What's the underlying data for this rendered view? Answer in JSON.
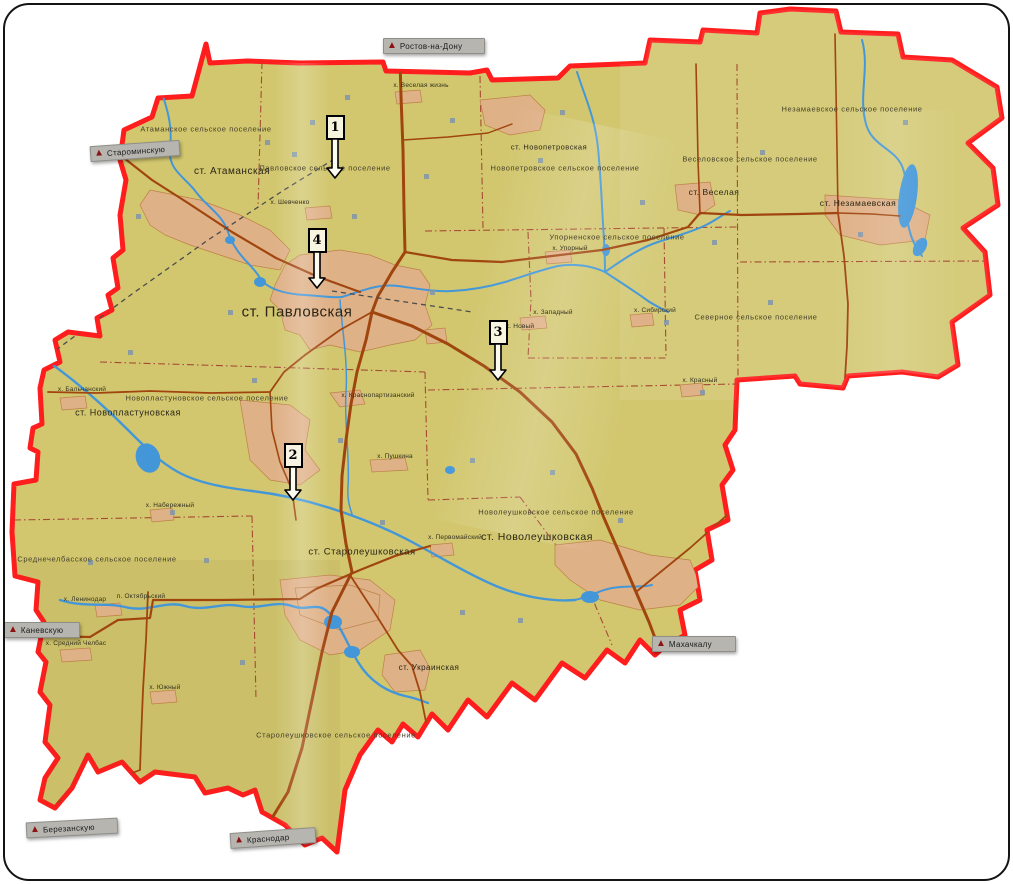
{
  "map_name": "district-wall-map-photo",
  "colors": {
    "land": "#d2c76f",
    "district_border": "#ff1d1d",
    "river": "#4397d9",
    "road": "#a1450f",
    "urban": "#dfb187",
    "urban_edge": "#bd8147",
    "settlement_boundary": "#a64a33",
    "railway": "#4c4c4c",
    "sign_background": "#b6b5b0",
    "sign_text": "#1b1b1b"
  },
  "stations": [
    {
      "label": "ст. Павловская",
      "x": 297,
      "y": 312,
      "size": 15
    },
    {
      "label": "ст. Атаманская",
      "x": 232,
      "y": 172,
      "size": 10
    },
    {
      "label": "ст. Новопетровская",
      "x": 549,
      "y": 147,
      "size": 7.5
    },
    {
      "label": "ст. Веселая",
      "x": 714,
      "y": 192,
      "size": 8.5
    },
    {
      "label": "ст. Незамаевская",
      "x": 858,
      "y": 203,
      "size": 8.5
    },
    {
      "label": "ст. Новопластуновская",
      "x": 128,
      "y": 413,
      "size": 9
    },
    {
      "label": "ст. Старолеушковская",
      "x": 362,
      "y": 552,
      "size": 9.5
    },
    {
      "label": "ст. Новолеушковская",
      "x": 537,
      "y": 537,
      "size": 10.5
    },
    {
      "label": "ст. Украинская",
      "x": 429,
      "y": 668,
      "size": 8
    }
  ],
  "settlements": [
    {
      "label": "Атаманское сельское поселение",
      "x": 206,
      "y": 129
    },
    {
      "label": "Павловское сельское поселение",
      "x": 325,
      "y": 168
    },
    {
      "label": "Новопетровское сельское поселение",
      "x": 565,
      "y": 168
    },
    {
      "label": "Веселовское сельское поселение",
      "x": 750,
      "y": 159
    },
    {
      "label": "Незамаевское сельское поселение",
      "x": 852,
      "y": 109
    },
    {
      "label": "Упорненское сельское поселение",
      "x": 617,
      "y": 237
    },
    {
      "label": "Северное сельское поселение",
      "x": 756,
      "y": 317
    },
    {
      "label": "Новопластуновское сельское поселение",
      "x": 207,
      "y": 398
    },
    {
      "label": "Среднечелбасское сельское поселение",
      "x": 97,
      "y": 559
    },
    {
      "label": "Новолеушковское сельское поселение",
      "x": 556,
      "y": 512
    },
    {
      "label": "Старолеушковское сельское поселение",
      "x": 336,
      "y": 735
    }
  ],
  "hamlets": [
    {
      "label": "х. Веселая жизнь",
      "x": 421,
      "y": 86
    },
    {
      "label": "х. Шевченко",
      "x": 290,
      "y": 203
    },
    {
      "label": "х. Упорный",
      "x": 570,
      "y": 249
    },
    {
      "label": "х. Западный",
      "x": 553,
      "y": 313
    },
    {
      "label": "х. Новый",
      "x": 520,
      "y": 327
    },
    {
      "label": "х. Сибирский",
      "x": 655,
      "y": 311
    },
    {
      "label": "х. Красный",
      "x": 700,
      "y": 381
    },
    {
      "label": "х. Бальчанский",
      "x": 82,
      "y": 390
    },
    {
      "label": "х. Краснопартизанский",
      "x": 378,
      "y": 396
    },
    {
      "label": "х. Пушкина",
      "x": 395,
      "y": 457
    },
    {
      "label": "х. Набережный",
      "x": 170,
      "y": 506
    },
    {
      "label": "х. Первомайский",
      "x": 455,
      "y": 538
    },
    {
      "label": "х. Ленинодар",
      "x": 85,
      "y": 600
    },
    {
      "label": "п. Октябрьский",
      "x": 141,
      "y": 597
    },
    {
      "label": "х. Средний Челбас",
      "x": 76,
      "y": 644
    },
    {
      "label": "х. Южный",
      "x": 165,
      "y": 688
    }
  ],
  "signs": [
    {
      "label": "Ростов-на-Дону",
      "x": 383,
      "y": 38,
      "w": 92,
      "angle": 0
    },
    {
      "label": "Староминскую",
      "x": 90,
      "y": 143,
      "w": 80,
      "angle": -4
    },
    {
      "label": "Каневскую",
      "x": 4,
      "y": 622,
      "w": 66,
      "angle": 0
    },
    {
      "label": "Махачкалу",
      "x": 652,
      "y": 636,
      "w": 74,
      "angle": 0
    },
    {
      "label": "Березанскую",
      "x": 26,
      "y": 820,
      "w": 82,
      "angle": -3
    },
    {
      "label": "Краснодар",
      "x": 230,
      "y": 830,
      "w": 76,
      "angle": -4
    }
  ],
  "route_markers": [
    {
      "number": "1",
      "x": 335,
      "y": 115,
      "arrow_len": 40
    },
    {
      "number": "4",
      "x": 317,
      "y": 228,
      "arrow_len": 37
    },
    {
      "number": "2",
      "x": 293,
      "y": 443,
      "arrow_len": 34
    },
    {
      "number": "3",
      "x": 498,
      "y": 320,
      "arrow_len": 37
    }
  ]
}
